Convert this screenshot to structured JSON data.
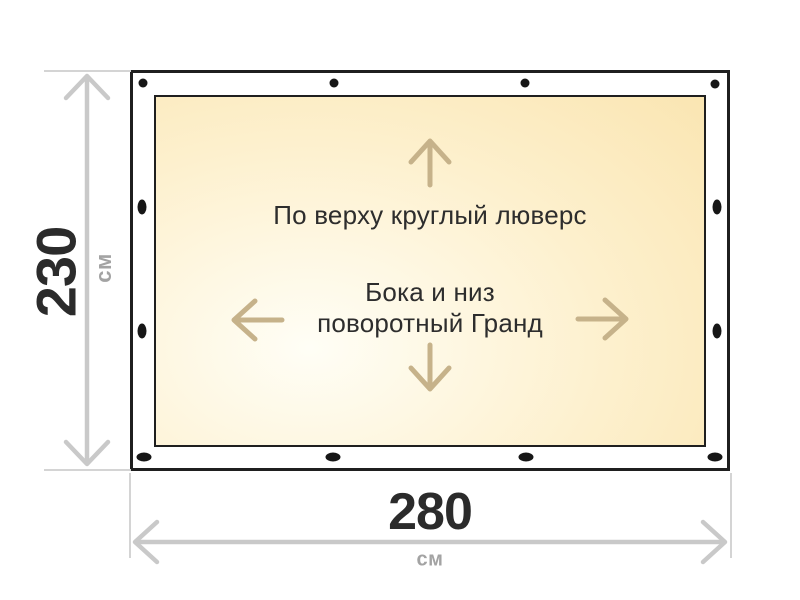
{
  "fabric_labels": {
    "top_edge_note": "По верху круглый люверс",
    "sides_note_line1": "Бока и низ",
    "sides_note_line2": "поворотный Гранд"
  },
  "dimensions": {
    "height": {
      "value": "230",
      "unit": "см"
    },
    "width": {
      "value": "280",
      "unit": "см"
    }
  },
  "grommets": {
    "top_count": 4,
    "bottom_count": 4,
    "left_count": 2,
    "right_count": 2
  },
  "icons": {
    "up": "arrow-up-icon",
    "down": "arrow-down-icon",
    "left": "arrow-left-icon",
    "right": "arrow-right-icon",
    "grommet": "grommet-dot"
  },
  "colors": {
    "page_bg": "#ffffff",
    "border_dark": "#1f1f1f",
    "fabric_light": "#fffef6",
    "fabric_mid": "#fdf0cd",
    "fabric_deep": "#f9e1a7",
    "arrow_tan": "#c6b28a",
    "dimension_gray": "#c9c9c9",
    "guide_gray": "#d4d4d4",
    "value_text": "#2b2b2b",
    "unit_text": "#a3a3a3",
    "label_text": "#2d2d2d",
    "grommet": "#161616"
  }
}
